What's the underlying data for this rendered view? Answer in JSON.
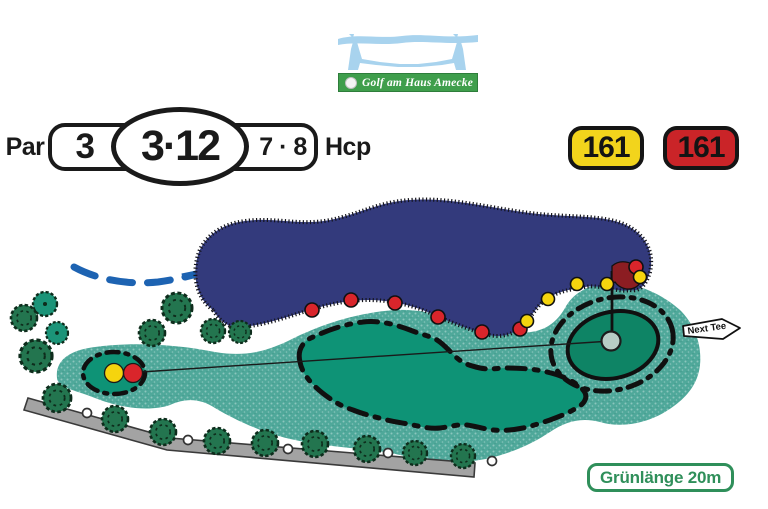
{
  "club": {
    "logo_text": "Golf am Haus Amecke"
  },
  "scorecard": {
    "par_label": "Par",
    "par_value": "3",
    "hole_display": "3·12",
    "hcp_value": "7 · 8",
    "hcp_label": "Hcp",
    "distances": [
      {
        "tee": "yellow",
        "value": "161",
        "color": "#f2d41c"
      },
      {
        "tee": "red",
        "value": "161",
        "color": "#ca2428"
      }
    ]
  },
  "course_map": {
    "next_tee_label": "Next Tee",
    "green_length_label": "Grünlänge 20m",
    "features": [
      "water-hazard",
      "stream-dashed",
      "rough",
      "fairway",
      "tee-box",
      "putting-green",
      "flag",
      "cart-path",
      "trees",
      "boundary-stakes"
    ],
    "tee_markers": [
      {
        "color": "yellow"
      },
      {
        "color": "red"
      }
    ],
    "hazard_stakes": {
      "red_count": 7,
      "yellow_count": 5
    },
    "colors": {
      "water": "#333a7c",
      "rough": "#4fa89a",
      "fairway": "#0e9376",
      "green": "#0e8465",
      "flag": "#8c1d22",
      "path": "#a3a3a3",
      "stake_red": "#d9252b",
      "stake_yellow": "#f5d40e"
    }
  }
}
